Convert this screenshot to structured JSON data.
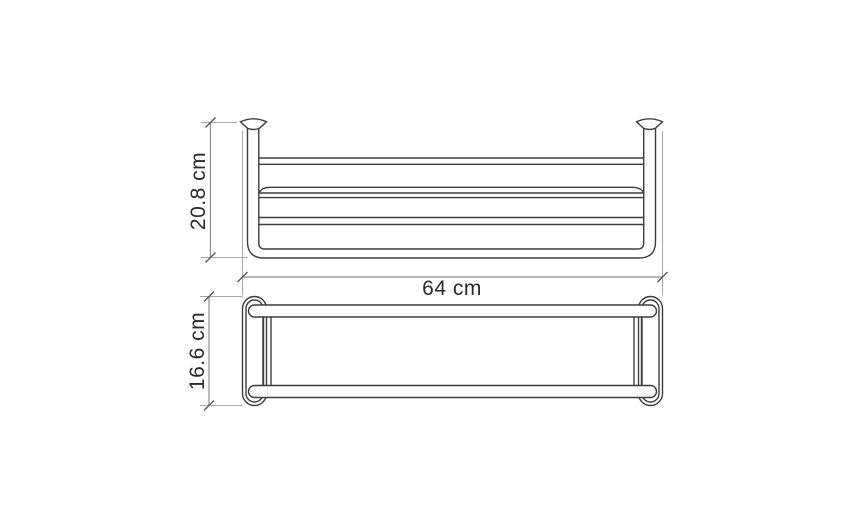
{
  "diagram": {
    "type": "technical-drawing",
    "subject": "wall-mounted towel rack shelf, dimensioned front and top views",
    "views": [
      {
        "name": "front-view",
        "dimensions": [
          "20.8 cm",
          "64 cm"
        ]
      },
      {
        "name": "top-view",
        "dimensions": [
          "16.6 cm"
        ]
      }
    ],
    "measurements": {
      "height_cm": 20.8,
      "width_cm": 64,
      "depth_cm": 16.6
    }
  },
  "labels": {
    "height": "20.8 cm",
    "width": "64 cm",
    "depth": "16.6 cm"
  },
  "colors": {
    "background": "#ffffff",
    "drawing_line": "#3d3d40",
    "dimension_line": "#8c8c90",
    "extension_line": "#a8a8ac",
    "label_text": "#2b2b2b"
  }
}
